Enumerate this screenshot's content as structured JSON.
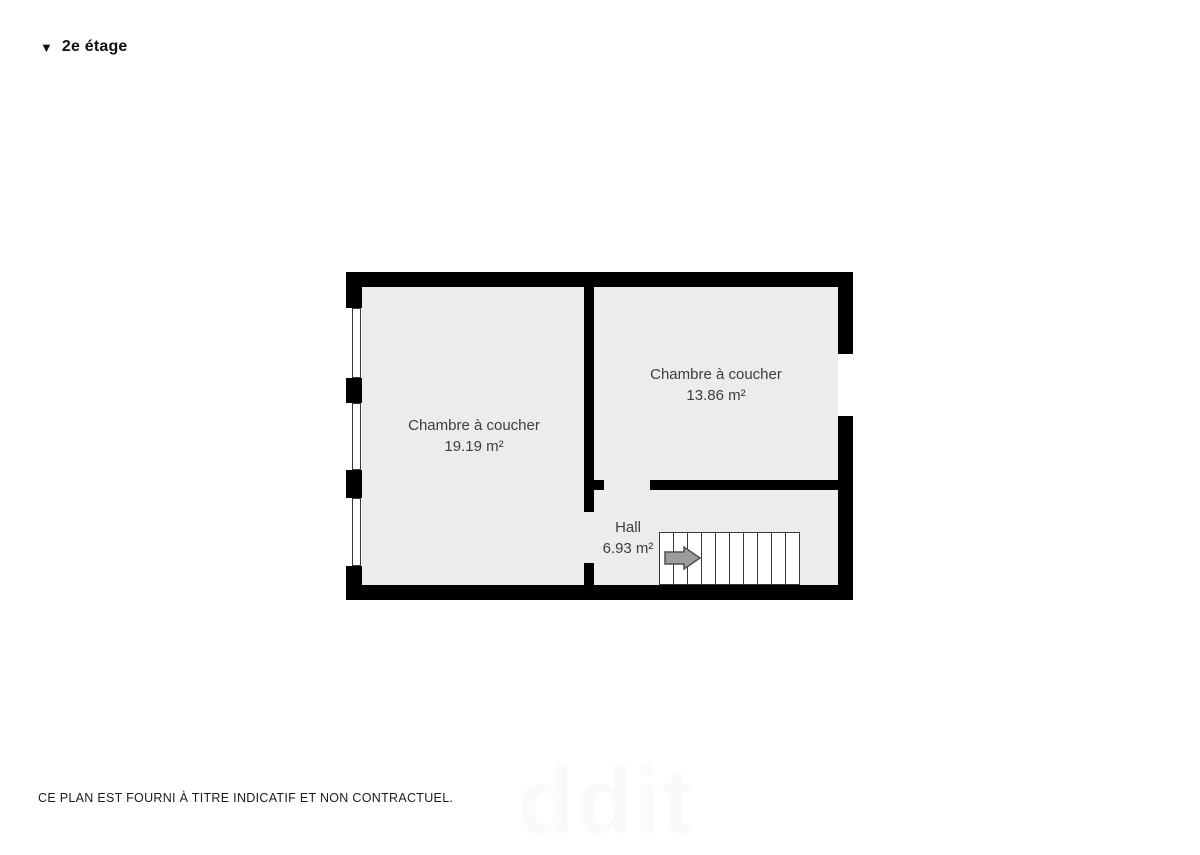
{
  "page": {
    "title": {
      "icon": "▼",
      "label": "2e étage"
    },
    "disclaimer": "CE PLAN EST FOURNI À TITRE INDICATIF ET NON CONTRACTUEL.",
    "watermark": "ddit"
  },
  "floorplan": {
    "colors": {
      "wall": "#000000",
      "floor": "#ececec",
      "stair_outline": "#3a3a3a",
      "label": "#3d3d3d",
      "arrow_fill": "#9c9c9c",
      "arrow_stroke": "#4f4f4f"
    },
    "rooms": [
      {
        "id": "bedroom-left",
        "name": "Chambre à coucher",
        "area": "19.19 m²"
      },
      {
        "id": "bedroom-right",
        "name": "Chambre à coucher",
        "area": "13.86 m²"
      },
      {
        "id": "hall",
        "name": "Hall",
        "area": "6.93 m²"
      }
    ],
    "stairs": {
      "tread_count": 10,
      "direction": "right"
    }
  }
}
